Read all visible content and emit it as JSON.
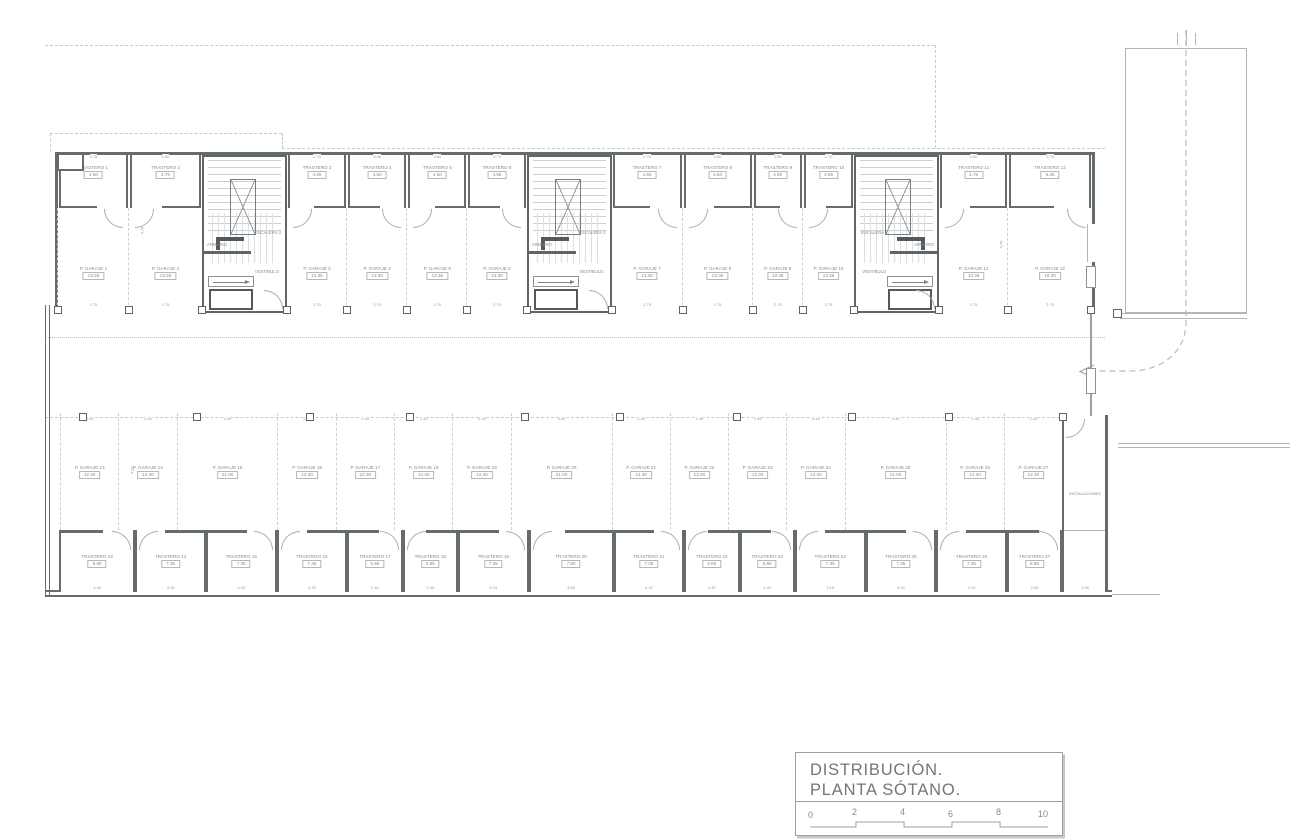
{
  "meta": {
    "ink_color": "#666b6e",
    "thin_line_color": "#b2b6b8",
    "text_color": "#85898c",
    "background": "#ffffff"
  },
  "title_block": {
    "line1": "DISTRIBUCIÓN.",
    "line2": "PLANTA SÓTANO.",
    "scale_ticks": [
      "0",
      "2",
      "4",
      "6",
      "8",
      "10"
    ]
  },
  "plan": {
    "instalaciones_label": "INSTALACIONES",
    "side_dims": {
      "d1": "4.75",
      "d2": "4.70",
      "d3": "4.90"
    },
    "end_bay_dim": "1.95",
    "top_cells": [
      {
        "type": "garage",
        "tl": "TRASTERO 1",
        "ta": "4.50",
        "td": "2.78",
        "gl": "P. GARAJE 1",
        "ga": "13.36",
        "bd": "2.75",
        "w": 72
      },
      {
        "type": "garage",
        "tl": "TRASTERO 2",
        "ta": "4.75",
        "td": "2.80",
        "gl": "P. GARAJE 2",
        "ga": "13.36",
        "bd": "2.75",
        "w": 74
      },
      {
        "type": "core",
        "label": "ESCALERA 3",
        "armario": "ARMARIO",
        "vestibulo": "VESTÍBULO",
        "w": 82
      },
      {
        "type": "garage",
        "tl": "TRASTERO 3",
        "ta": "4.55",
        "td": "2.70",
        "gl": "P. GARAJE 3",
        "ga": "13.36",
        "bd": "2.70",
        "w": 61
      },
      {
        "type": "garage",
        "tl": "TRASTERO 4",
        "ta": "4.50",
        "td": "3.45",
        "gl": "P. GARAJE 4",
        "ga": "13.36",
        "bd": "2.70",
        "w": 61
      },
      {
        "type": "garage",
        "tl": "TRASTERO 5",
        "ta": "4.50",
        "td": "3.60",
        "gl": "P. GARAJE 5",
        "ga": "13.36",
        "bd": "2.70",
        "w": 61
      },
      {
        "type": "garage",
        "tl": "TRASTERO 6",
        "ta": "4.55",
        "td": "2.70",
        "gl": "P. GARAJE 6",
        "ga": "13.36",
        "bd": "2.70",
        "w": 60
      },
      {
        "type": "core",
        "label": "ESCALERA 2",
        "armario": "ARMARIO",
        "vestibulo": "VESTÍBULO",
        "w": 82
      },
      {
        "type": "garage",
        "tl": "TRASTERO 7",
        "ta": "4.55",
        "td": "2.75",
        "gl": "P. GARAJE 7",
        "ga": "13.36",
        "bd": "2.75",
        "w": 72
      },
      {
        "type": "garage",
        "tl": "TRASTERO 8",
        "ta": "4.50",
        "td": "2.60",
        "gl": "P. GARAJE 8",
        "ga": "13.36",
        "bd": "2.75",
        "w": 71
      },
      {
        "type": "garage",
        "tl": "TRASTERO 9",
        "ta": "4.50",
        "td": "2.65",
        "gl": "P. GARAJE 9",
        "ga": "13.36",
        "bd": "2.75",
        "w": 51
      },
      {
        "type": "garage",
        "tl": "TRASTERO 10",
        "ta": "4.55",
        "td": "2.70",
        "gl": "P. GARAJE 10",
        "ga": "13.36",
        "bd": "2.75",
        "w": 52
      },
      {
        "type": "core",
        "label": "ESCALERA 1",
        "armario": "ARMARIO",
        "vestibulo": "VESTÍBULO",
        "mirrored": true,
        "w": 82
      },
      {
        "type": "garage",
        "tl": "TRASTERO 11",
        "ta": "4.75",
        "td": "2.60",
        "gl": "P. GARAJE 11",
        "ga": "13.36",
        "bd": "2.75",
        "w": 70
      },
      {
        "type": "garage",
        "tl": "TRASTERO 12",
        "ta": "6.35",
        "td": "2.75",
        "gl": "P. GARAJE 12",
        "ga": "18.30",
        "bd": "2.70",
        "w": 85
      }
    ],
    "mid_spaces": [
      {
        "label": "P. GARAJE 13",
        "area": "12.30",
        "dim": "2.45",
        "w": 55
      },
      {
        "label": "P. GARAJE 14",
        "area": "12.30",
        "dim": "2.45",
        "w": 55
      },
      {
        "label": "P. GARAJE 15",
        "area": "21.00",
        "dim": "4.30",
        "w": 96
      },
      {
        "label": "P. GARAJE 16",
        "area": "12.30",
        "dim": "2.45",
        "w": 55
      },
      {
        "label": "P. GARAJE 17",
        "area": "12.30",
        "dim": "2.45",
        "w": 55
      },
      {
        "label": "P. GARAJE 18",
        "area": "12.30",
        "dim": "2.45",
        "w": 55
      },
      {
        "label": "P. GARAJE 19",
        "area": "12.30",
        "dim": "2.45",
        "w": 55
      },
      {
        "label": "P. GARAJE 20",
        "area": "21.00",
        "dim": "4.30",
        "w": 96
      },
      {
        "label": "P. GARAJE 21",
        "area": "12.30",
        "dim": "2.45",
        "w": 55
      },
      {
        "label": "P. GARAJE 22",
        "area": "12.30",
        "dim": "2.45",
        "w": 55
      },
      {
        "label": "P. GARAJE 23",
        "area": "12.30",
        "dim": "2.45",
        "w": 55
      },
      {
        "label": "P. GARAJE 24",
        "area": "12.30",
        "dim": "2.45",
        "w": 55
      },
      {
        "label": "P. GARAJE 25",
        "area": "21.00",
        "dim": "4.30",
        "w": 96
      },
      {
        "label": "P. GARAJE 26",
        "area": "12.30",
        "dim": "2.45",
        "w": 55
      },
      {
        "label": "P. GARAJE 27",
        "area": "12.30",
        "dim": "2.45",
        "w": 55
      }
    ],
    "low_rooms": [
      {
        "label": "TRASTERO 13",
        "area": "8.90",
        "dim": "3.40",
        "w": 76
      },
      {
        "label": "TRASTERO 14",
        "area": "7.35",
        "dim": "3.15",
        "w": 70
      },
      {
        "label": "TRASTERO 15",
        "area": "7.35",
        "dim": "3.15",
        "w": 70
      },
      {
        "label": "TRASTERO 16",
        "area": "7.35",
        "dim": "3.15",
        "w": 70
      },
      {
        "label": "TRASTERO 17",
        "area": "5.85",
        "dim": "2.40",
        "w": 54
      },
      {
        "label": "TRASTERO 18",
        "area": "5.85",
        "dim": "2.40",
        "w": 54
      },
      {
        "label": "TRASTERO 19",
        "area": "7.35",
        "dim": "3.15",
        "w": 70
      },
      {
        "label": "TRASTERO 20",
        "area": "7.80",
        "dim": "3.80",
        "w": 85
      },
      {
        "label": "TRASTERO 21",
        "area": "7.35",
        "dim": "3.15",
        "w": 70
      },
      {
        "label": "TRASTERO 22",
        "area": "5.85",
        "dim": "2.40",
        "w": 54
      },
      {
        "label": "TRASTERO 23",
        "area": "5.85",
        "dim": "2.40",
        "w": 54
      },
      {
        "label": "TRASTERO 24",
        "area": "7.35",
        "dim": "3.15",
        "w": 70
      },
      {
        "label": "TRASTERO 25",
        "area": "7.35",
        "dim": "3.15",
        "w": 70
      },
      {
        "label": "TRASTERO 26",
        "area": "7.35",
        "dim": "3.15",
        "w": 70
      },
      {
        "label": "TRASTERO 27",
        "area": "5.85",
        "dim": "2.40",
        "w": 54
      },
      {
        "label": "",
        "area": "",
        "dim": "1.95",
        "empty": true,
        "w": 44
      }
    ]
  }
}
